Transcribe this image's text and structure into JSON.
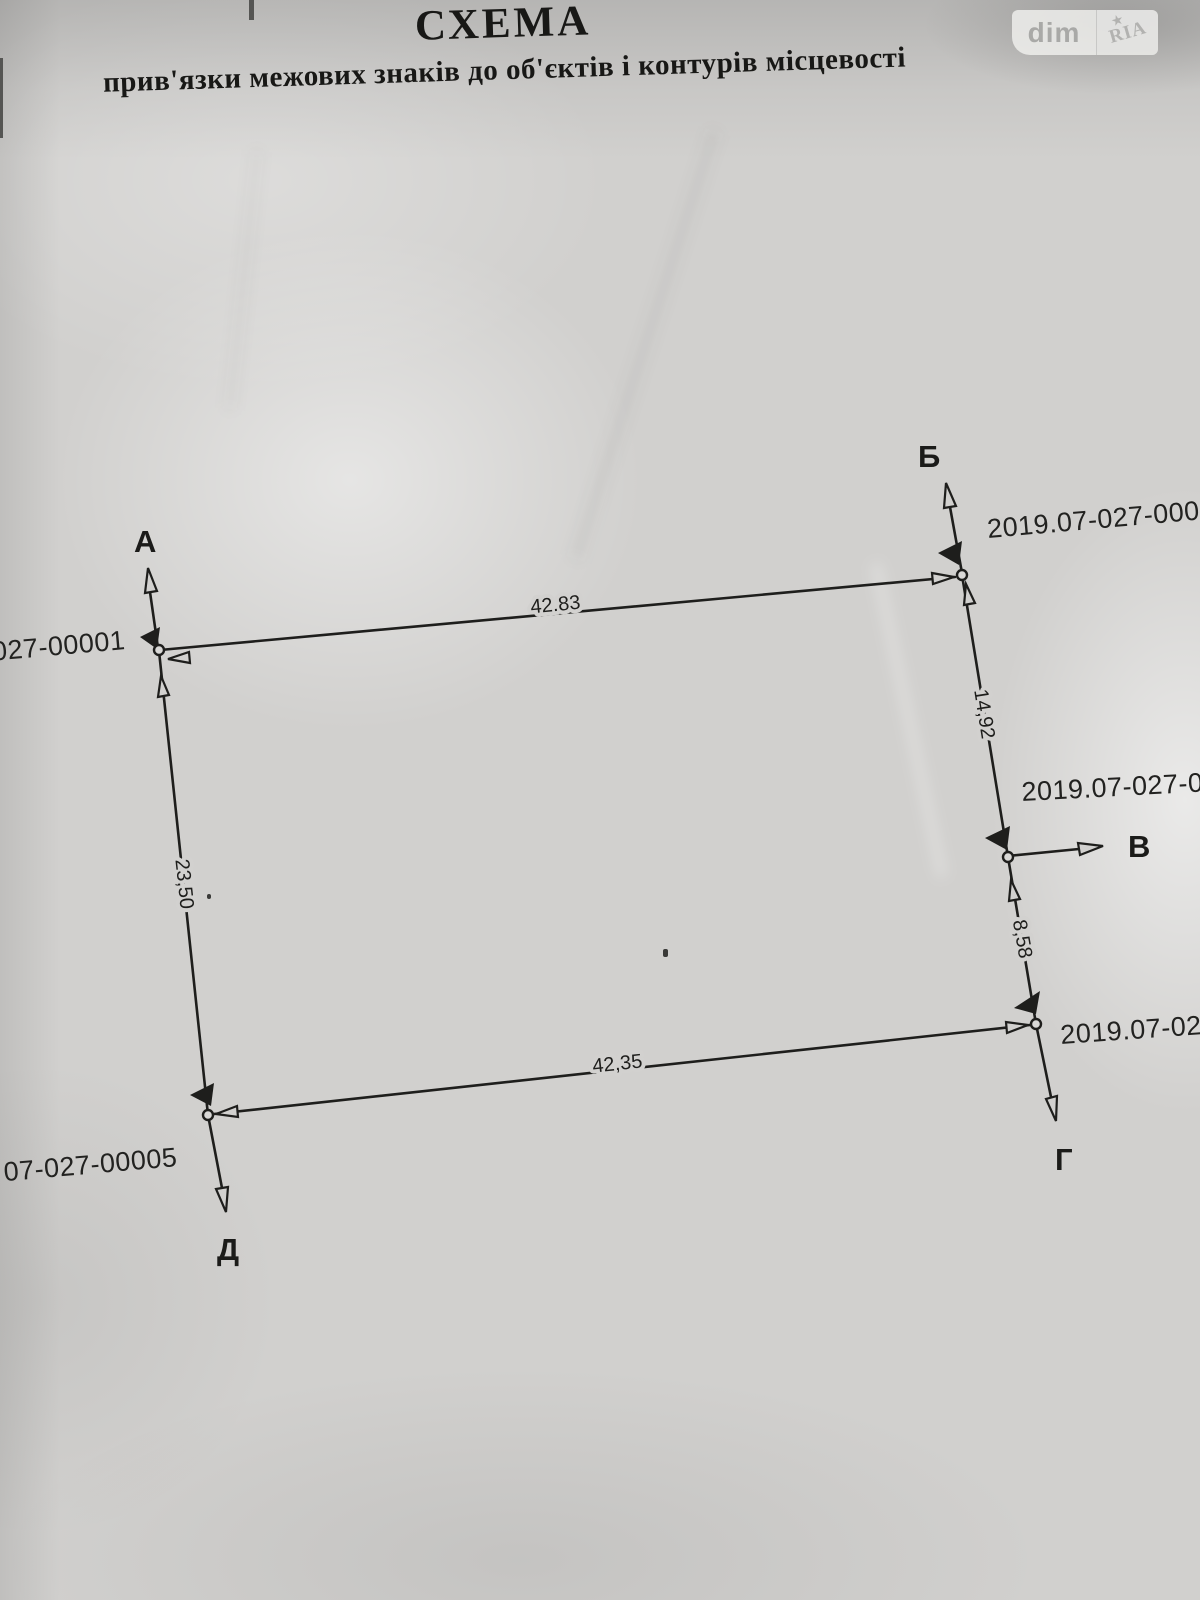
{
  "watermark": {
    "left_text": "dim",
    "right_text": "RIA",
    "star": "★"
  },
  "header": {
    "title": "СХЕМА",
    "subtitle": "прив'язки межових знаків до об'єктів і контурів місцевості"
  },
  "diagram": {
    "ink_color": "#1e1e1c",
    "paper_color": "#d1d0ce",
    "points": [
      {
        "id": "A",
        "label": "А"
      },
      {
        "id": "B",
        "label": "Б"
      },
      {
        "id": "V",
        "label": "В"
      },
      {
        "id": "G",
        "label": "Г"
      },
      {
        "id": "D",
        "label": "Д"
      }
    ],
    "cadastral_labels": [
      {
        "id": "left-top",
        "text": "027-00001"
      },
      {
        "id": "top-right",
        "text": "2019.07-027-0000"
      },
      {
        "id": "right-middle",
        "text": "2019.07-027-00"
      },
      {
        "id": "right-bottom",
        "text": "2019.07-02"
      },
      {
        "id": "bottom-left",
        "text": "07-027-00005"
      }
    ],
    "dimensions": [
      {
        "edge": "top",
        "text": "42.83"
      },
      {
        "edge": "right-upper",
        "text": "14,92"
      },
      {
        "edge": "right-lower",
        "text": "8,58"
      },
      {
        "edge": "bottom",
        "text": "42,35"
      },
      {
        "edge": "left",
        "text": "23,50"
      }
    ]
  }
}
